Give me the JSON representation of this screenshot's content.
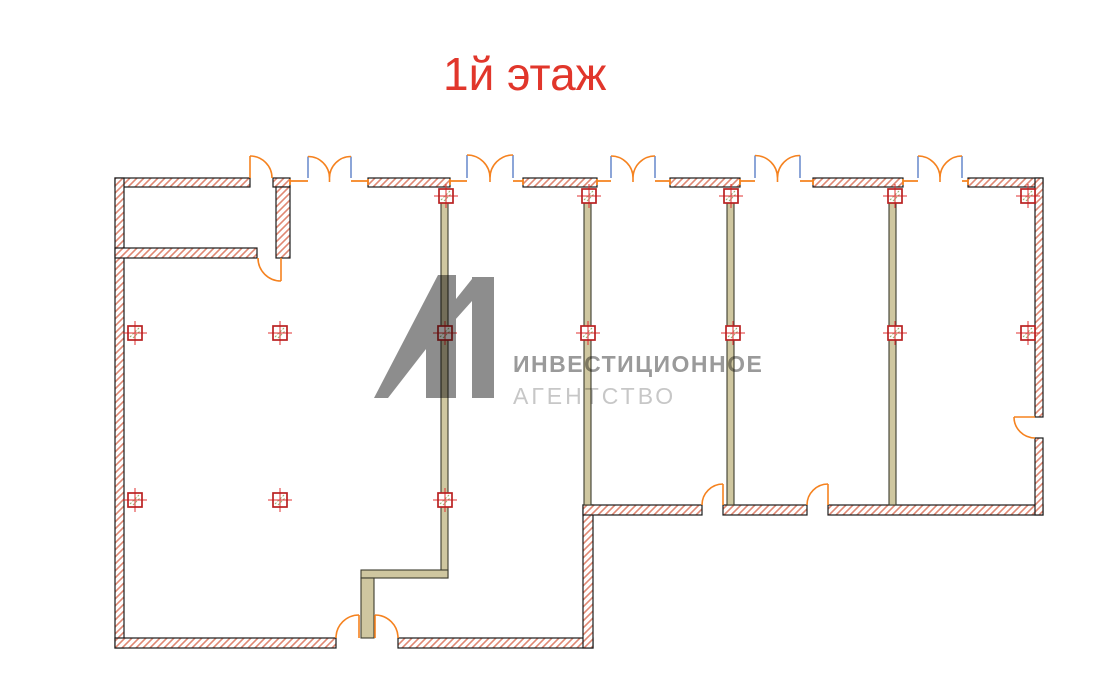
{
  "title": {
    "text": "1й этаж",
    "color": "#e1362b"
  },
  "watermark": {
    "glyph": "A1-logo",
    "glyph_color": "#8d8d8d",
    "line1": "ИНВЕСТИЦИОННОЕ",
    "line2": "АГЕНТСТВО",
    "line1_color": "#9a9a9a",
    "line2_color": "#c7c7c7"
  },
  "plan": {
    "colors": {
      "hatch": "#e08873",
      "outline": "#1a1a1a",
      "olive_fill": "#cfc7a0",
      "olive_stroke": "#3c3c2e",
      "door_orange": "#f5821f",
      "jamb_blue": "#6f8fce",
      "column_red": "#b92121",
      "column_cross": "#e03030",
      "column_green": "#92b06e"
    },
    "walls_hatched": [
      [
        115,
        178,
        135,
        9
      ],
      [
        273,
        178,
        17,
        9
      ],
      [
        368,
        178,
        82,
        9
      ],
      [
        523,
        178,
        74,
        9
      ],
      [
        670,
        178,
        70,
        9
      ],
      [
        813,
        178,
        90,
        9
      ],
      [
        968,
        178,
        75,
        9
      ],
      [
        115,
        178,
        9,
        470
      ],
      [
        115,
        638,
        221,
        10
      ],
      [
        398,
        638,
        195,
        10
      ],
      [
        583,
        505,
        10,
        143
      ],
      [
        583,
        505,
        119,
        10
      ],
      [
        723,
        505,
        84,
        10
      ],
      [
        828,
        505,
        215,
        10
      ],
      [
        1035,
        178,
        8,
        239
      ],
      [
        1035,
        438,
        8,
        77
      ],
      [
        115,
        248,
        142,
        10
      ],
      [
        276,
        187,
        14,
        71
      ]
    ],
    "walls_olive": [
      [
        441,
        203,
        7,
        375
      ],
      [
        361,
        570,
        87,
        8
      ],
      [
        361,
        578,
        13,
        60
      ],
      [
        584,
        203,
        7,
        302
      ],
      [
        727,
        203,
        7,
        302
      ],
      [
        889,
        203,
        7,
        302
      ]
    ],
    "double_doors": [
      {
        "a": 308,
        "b": 351,
        "s1": [
          290,
          308
        ],
        "s2": [
          351,
          368
        ]
      },
      {
        "a": 467,
        "b": 513,
        "s1": [
          450,
          467
        ],
        "s2": [
          513,
          523
        ]
      },
      {
        "a": 611,
        "b": 655,
        "s1": [
          597,
          611
        ],
        "s2": [
          655,
          670
        ]
      },
      {
        "a": 755,
        "b": 800,
        "s1": [
          740,
          755
        ],
        "s2": [
          800,
          813
        ]
      },
      {
        "a": 918,
        "b": 962,
        "s1": [
          903,
          918
        ],
        "s2": [
          962,
          968
        ]
      }
    ],
    "single_doors": [
      {
        "name": "door-vestibule-top",
        "leaf": [
          250,
          178,
          250,
          156
        ],
        "arc": "M 250,156 A 22 22 0 0 1 272,178"
      },
      {
        "name": "door-vestibule-inner",
        "leaf": [
          281,
          258,
          281,
          281
        ],
        "arc": "M 258,258 A 23 23 0 0 0 281,281"
      },
      {
        "name": "door-room-b",
        "leaf": [
          723,
          505,
          723,
          484
        ],
        "arc": "M 702,505 A 21 21 0 0 1 723,484"
      },
      {
        "name": "door-room-c",
        "leaf": [
          828,
          505,
          828,
          484
        ],
        "arc": "M 807,505 A 21 21 0 0 1 828,484"
      },
      {
        "name": "door-right-wall",
        "leaf": [
          1035,
          417,
          1014,
          417
        ],
        "arc": "M 1014,417 A 21 21 0 0 0 1035,438"
      },
      {
        "name": "door-entrance-left",
        "leaf": [
          359,
          638,
          359,
          615
        ],
        "arc": "M 336,638 A 23 23 0 0 1 359,615"
      },
      {
        "name": "door-entrance-right",
        "leaf": [
          375,
          638,
          375,
          615
        ],
        "arc": "M 375,615 A 23 23 0 0 1 398,638"
      }
    ],
    "columns": [
      [
        446,
        196
      ],
      [
        589,
        196
      ],
      [
        731,
        196
      ],
      [
        895,
        196
      ],
      [
        1028,
        196
      ],
      [
        135,
        333
      ],
      [
        280,
        333
      ],
      [
        445,
        333
      ],
      [
        588,
        333
      ],
      [
        733,
        333
      ],
      [
        895,
        333
      ],
      [
        1028,
        333
      ],
      [
        135,
        500
      ],
      [
        280,
        500
      ],
      [
        445,
        500
      ]
    ]
  }
}
